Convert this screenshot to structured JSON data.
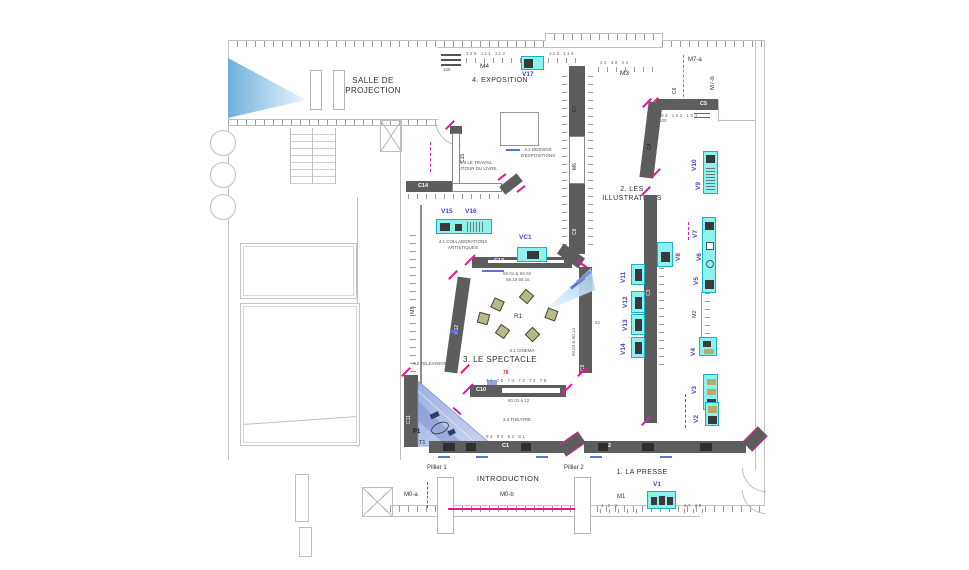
{
  "zones": {
    "projection": "SALLE DE\nPROJECTION",
    "z4": "4. EXPOSITION",
    "z2": "2. LES\nILLUSTRATIONS",
    "z3": "3. LE SPECTACLE",
    "z1": "1. LA PRESSE",
    "intro": "INTRODUCTION"
  },
  "sections": {
    "s41": "4.1 COLLABORATIONS\nARTISTIQUES",
    "s42": "4.2 DESSINS\nD'EXPOSITIONS",
    "s43": "4.3 LE TRAVAIL\nAUTOUR DU LIVRE",
    "s31": "3.1 CINEMA",
    "s32": "3.2 TELEVISION",
    "s33": "3.3 THEATRE"
  },
  "walls": {
    "c1": "C1",
    "c2": "C2",
    "c3": "C3",
    "c4": "C4",
    "c5": "C5",
    "c6": "C6",
    "c7": "C7",
    "c8": "C8",
    "c9": "C9",
    "c10": "C10",
    "c11": "C11",
    "c12": "C12",
    "c13": "C13",
    "c14": "C14",
    "c15": "C15",
    "m0a": "M0-a",
    "m0b": "M0-b",
    "m1": "M1",
    "m2": "M2",
    "m3": "M3",
    "m4": "M4",
    "m5": "M5",
    "m6": "M6",
    "m7a": "M7-a",
    "m7b": "M7-b"
  },
  "vitrines": {
    "v1": "V1",
    "v2": "V2",
    "v3": "V3",
    "v4": "V4",
    "v5": "V5",
    "v6": "V6",
    "v7": "V7",
    "v8": "V8",
    "v9": "V9",
    "v10": "V10",
    "v11": "V11",
    "v12": "V12",
    "v13": "V13",
    "v14": "V14",
    "v15": "V15",
    "v16": "V16",
    "v17": "V17",
    "vc1": "VC1"
  },
  "markers": {
    "r1": "R1",
    "p1": "P1",
    "t1": "T1",
    "pillier1": "Pillier 1",
    "pillier2": "Pillier 2"
  },
  "figures": {
    "f6901": "69.01 & 69.02",
    "f6915": "69.15  69.16",
    "f6001": "60.01 à 12",
    "f6003": "60.03 & 60.14",
    "c10red": "78",
    "c10row": "71  75  74  73  72  78",
    "c1row": "84  83  82  81",
    "m3row": "42   43   44",
    "m4row": "125  111  112",
    "m4n105": "105",
    "m4right": "113  114",
    "c5row": "103  102  104",
    "c5n100": "100",
    "m1row": "1   2   3",
    "m1row2": "27  28",
    "t62": "62"
  },
  "colors": {
    "accent_pink": "#e6189b",
    "case_cyan": "#8df1ee",
    "case_border": "#18b2c4",
    "vitrine_label": "#4a3fd0",
    "wall_dark": "#5d5d5d",
    "cone_blue": "#8ec6ea",
    "stage_blue": "#b0bde6",
    "seat_olive": "#b9ba8c",
    "red_mark": "#d93025",
    "blue_mark": "#5b74d6",
    "line_gray": "#c0c0c0"
  }
}
